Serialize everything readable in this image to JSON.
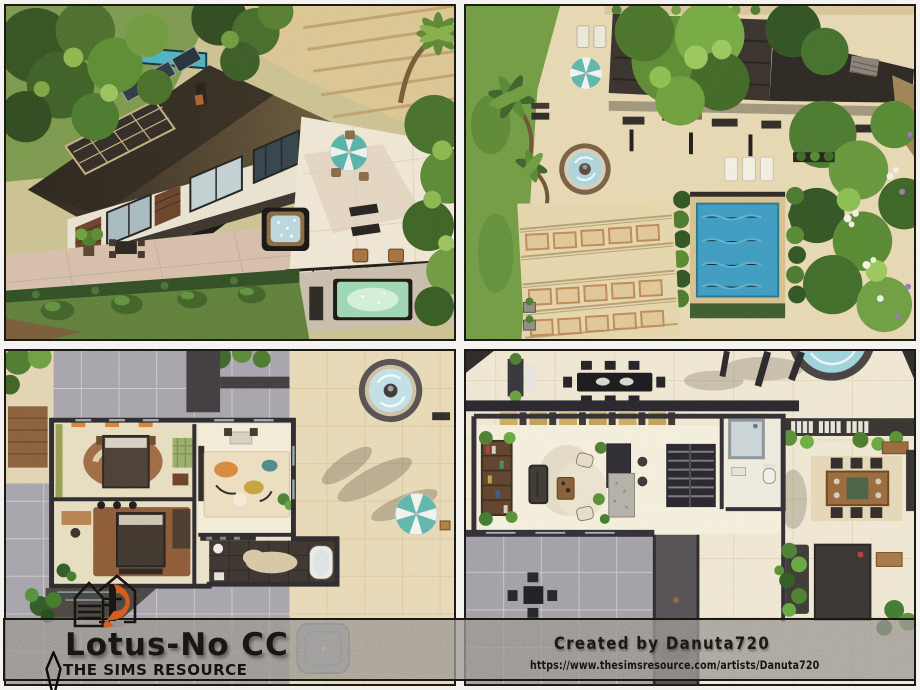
{
  "banner": {
    "title": "Lotus-No CC",
    "site_name": "THE SIMS RESOURCE",
    "credit": "Created by Danuta720",
    "artist_url": "https://www.thesimsresource.com/artists/Danuta720"
  },
  "logo": {
    "label": "Danuta720 house logo",
    "accent_orange": "#d85c1d"
  },
  "plumbob_icon": "plumbob-diamond-outline",
  "screenshots": [
    {
      "id": "exterior-aerial",
      "label": "Exterior aerial view of modern house with brown flat roof, hot tub terrace and small pool"
    },
    {
      "id": "backyard-top-down",
      "label": "Top-down backyard with round fountain, swimming pool, loungers and terraced garden steps"
    },
    {
      "id": "floor-plan-bedrooms",
      "label": "Top-down floor plan with bedrooms, living room rug, dark-tiled bathroom, fountain and umbrella patio"
    },
    {
      "id": "floor-plan-living",
      "label": "Top-down floor plan with living room, kitchen island, stairs, bathroom and dining area"
    }
  ],
  "colors": {
    "frame": "#16130f",
    "banner_fill": "rgba(152,148,143,0.75)",
    "accent_orange": "#d85c1d",
    "pool_blue": "#3f9fc4",
    "glow_pool_green": "#cde8c8",
    "roof_brown": "#4a3b28",
    "tile_cream": "#eadcb9",
    "grass_green": "#6f9a3f",
    "courtyard_gray": "#a9a5ad"
  }
}
